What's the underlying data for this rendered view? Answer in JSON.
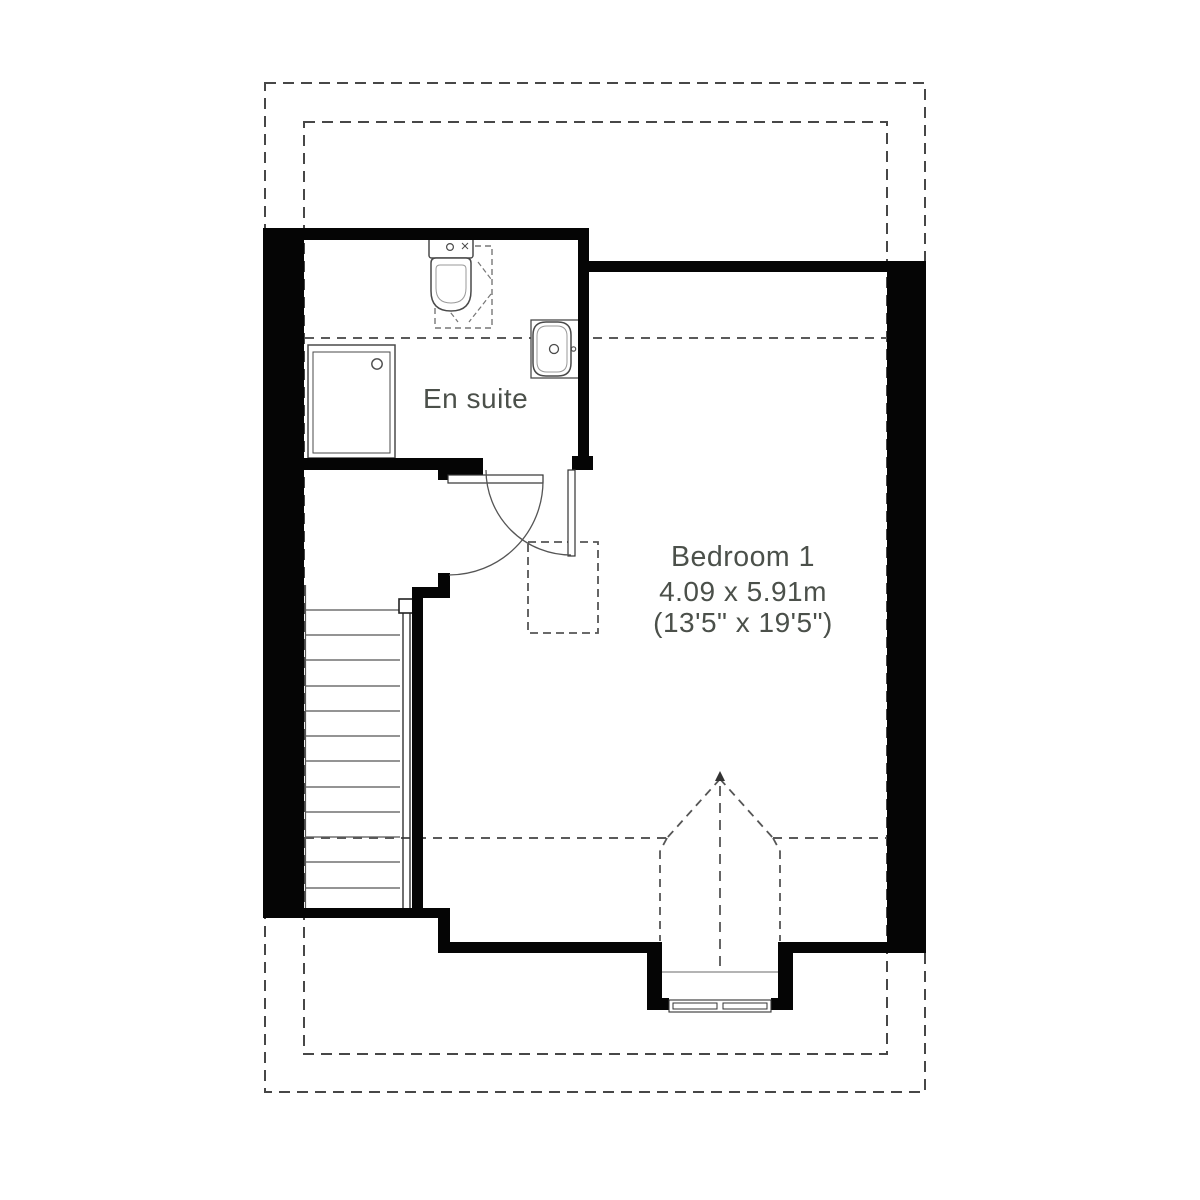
{
  "plan": {
    "rooms": [
      {
        "name": "En suite"
      },
      {
        "name": "Bedroom 1",
        "size_metric": "4.09 x 5.91m",
        "size_imperial": "(13'5\" x 19'5\")"
      }
    ],
    "colors": {
      "wall": "#050505",
      "fixture_line": "#4a4a4a",
      "dashed_line": "#474747",
      "text": "#4b504a",
      "background": "#ffffff"
    }
  }
}
